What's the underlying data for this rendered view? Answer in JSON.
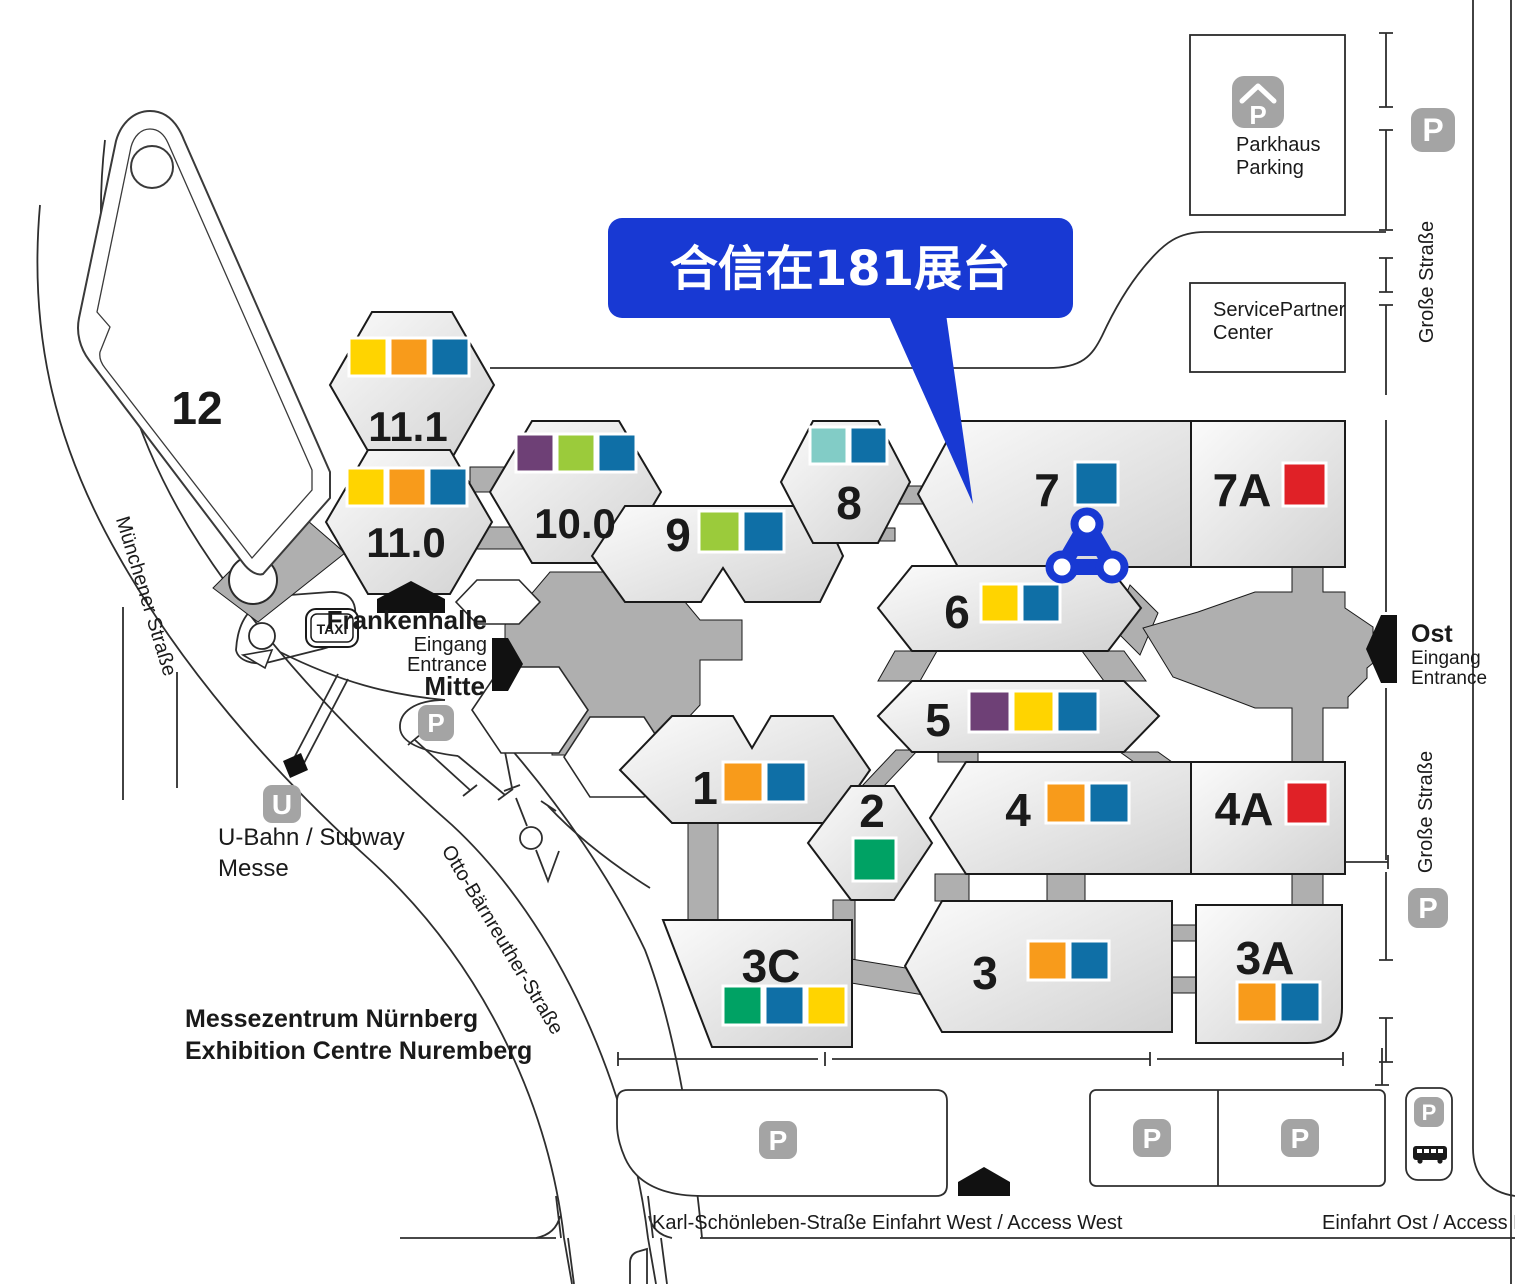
{
  "title": {
    "de": "Messezentrum Nürnberg",
    "en": "Exhibition Centre Nuremberg"
  },
  "brand": {
    "callout_text": "合信在181展台",
    "callout_color": "#1839D3",
    "logo_color": "#1839D3"
  },
  "palette": {
    "yellow": "#FFD400",
    "orange": "#F89B1B",
    "blue": "#0F6FA6",
    "green": "#9BCB3B",
    "purple": "#6E4076",
    "teal": "#82CCC6",
    "red": "#E02127",
    "emerald": "#00A264"
  },
  "halls": [
    {
      "label": "12",
      "chips": []
    },
    {
      "label": "11.1",
      "chips": [
        "yellow",
        "orange",
        "blue"
      ]
    },
    {
      "label": "11.0",
      "chips": [
        "yellow",
        "orange",
        "blue"
      ]
    },
    {
      "label": "10.0",
      "chips": [
        "purple",
        "green",
        "blue"
      ]
    },
    {
      "label": "9",
      "chips": [
        "green",
        "blue"
      ]
    },
    {
      "label": "8",
      "chips": [
        "teal",
        "blue"
      ]
    },
    {
      "label": "7",
      "chips": [
        "blue"
      ]
    },
    {
      "label": "7A",
      "chips": [
        "red"
      ]
    },
    {
      "label": "6",
      "chips": [
        "yellow",
        "blue"
      ]
    },
    {
      "label": "5",
      "chips": [
        "purple",
        "yellow",
        "blue"
      ]
    },
    {
      "label": "4",
      "chips": [
        "orange",
        "blue"
      ]
    },
    {
      "label": "4A",
      "chips": [
        "red"
      ]
    },
    {
      "label": "1",
      "chips": [
        "orange",
        "blue"
      ]
    },
    {
      "label": "2",
      "chips": [
        "emerald"
      ]
    },
    {
      "label": "3C",
      "chips": [
        "emerald",
        "blue",
        "yellow"
      ]
    },
    {
      "label": "3",
      "chips": [
        "orange",
        "blue"
      ]
    },
    {
      "label": "3A",
      "chips": [
        "orange",
        "blue"
      ]
    }
  ],
  "buildings": {
    "parkhaus_line1": "Parkhaus",
    "parkhaus_line2": "Parking",
    "service_line1": "ServicePartner",
    "service_line2": "Center",
    "frankenhalle": "Frankenhalle"
  },
  "entrances": {
    "mitte_line1": "Eingang",
    "mitte_line2": "Entrance",
    "mitte_line3": "Mitte",
    "ost_line1": "Ost",
    "ost_line2": "Eingang",
    "ost_line3": "Entrance",
    "west": "Einfahrt West / Access West",
    "east": "Einfahrt Ost / Access East"
  },
  "streets": {
    "muenchener": "Münchener Straße",
    "otto": "Otto-Bärnreuther-Straße",
    "karl": "Karl-Schönleben-Straße",
    "grosse": "Große Straße"
  },
  "transit": {
    "subway_line1": "U-Bahn / Subway",
    "subway_line2": "Messe",
    "taxi": "TAXI"
  },
  "icons": {
    "parking": "P",
    "subway_station": "U"
  }
}
